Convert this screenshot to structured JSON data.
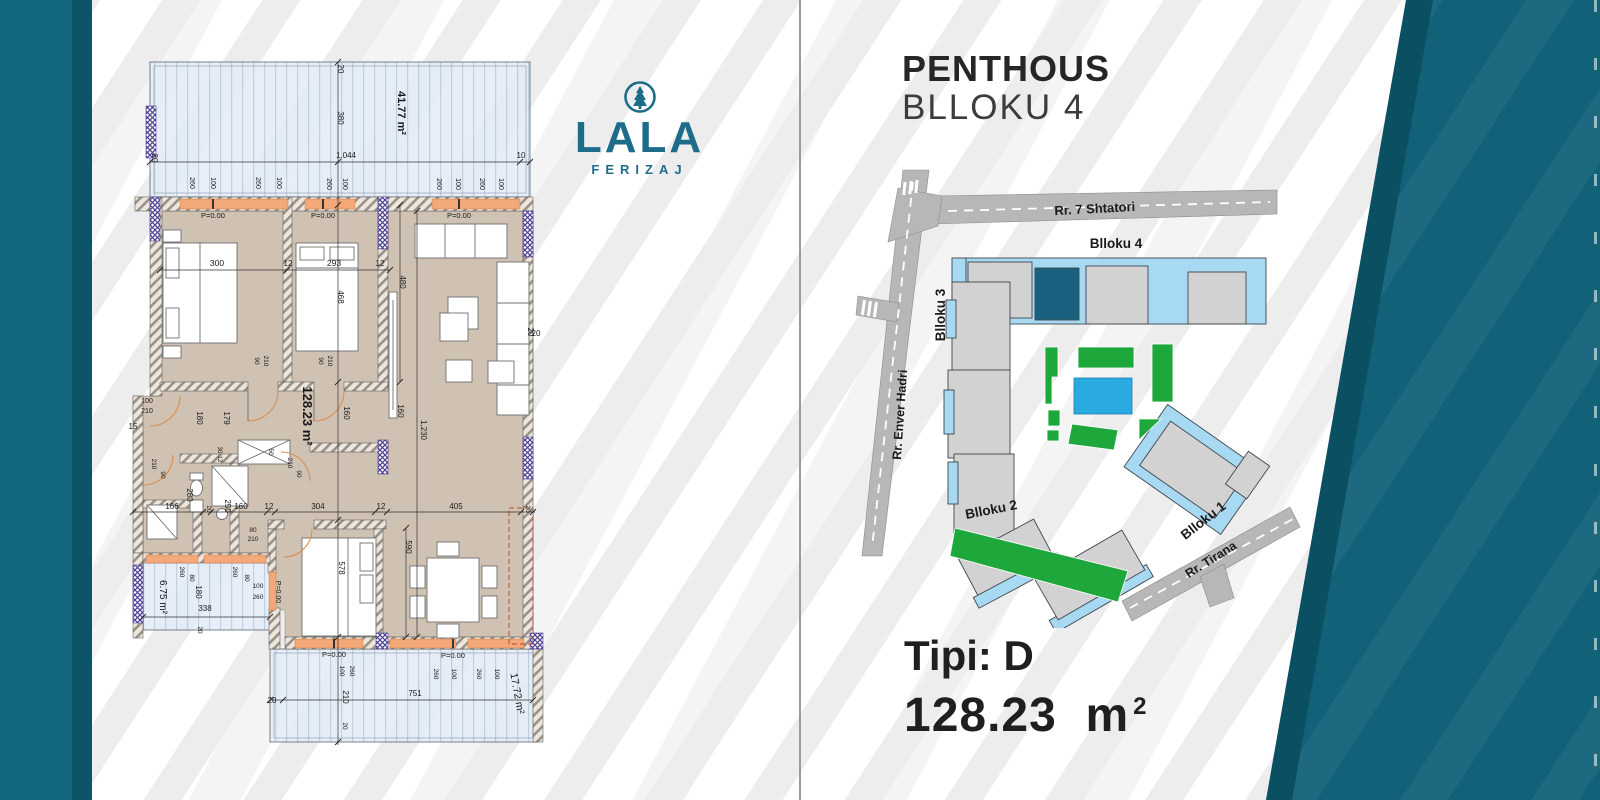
{
  "page": {
    "stripe_color": "#ededed",
    "teal_bar": "#13677f",
    "teal_dark": "#0c5468",
    "teal_wedge": "#116178"
  },
  "logo": {
    "name": "LALA",
    "city": "FERIZAJ",
    "color": "#1d6d8a",
    "icon": "pine-tree-circle-icon"
  },
  "header": {
    "line1": "PENTHOUS",
    "line2": "BLLOKU 4"
  },
  "type_block": {
    "label": "Tipi: D",
    "area_value": "128.23",
    "area_unit": "m",
    "area_sup": "2"
  },
  "floorplan": {
    "colors": {
      "floor": "#cfc2b2",
      "terrace": "#e3ecf7",
      "sill": "#f2a878",
      "column": "#4b3f92",
      "door_arc": "#dd8c4c",
      "dashed_outline": "#c4452e"
    },
    "labels": [
      {
        "t": "41.77 m²",
        "x": 398,
        "y": 113,
        "r": 90,
        "s": 11,
        "b": 1
      },
      {
        "t": "128.23 m²",
        "x": 303,
        "y": 416,
        "r": 90,
        "s": 13,
        "b": 1
      },
      {
        "t": "6.75 m²",
        "x": 160,
        "y": 597,
        "r": 90,
        "s": 10
      },
      {
        "t": "17.72 m²",
        "x": 514,
        "y": 694,
        "r": 80,
        "s": 10.5
      },
      {
        "t": "380",
        "x": 338,
        "y": 118,
        "r": 90,
        "s": 8
      },
      {
        "t": "20",
        "x": 338,
        "y": 69,
        "r": 90,
        "s": 8
      },
      {
        "t": "1,044",
        "x": 346,
        "y": 158,
        "s": 8
      },
      {
        "t": "10",
        "x": 521,
        "y": 158,
        "s": 8
      },
      {
        "t": "20",
        "x": 152,
        "y": 158,
        "r": 90,
        "s": 8
      },
      {
        "t": "260",
        "x": 190,
        "y": 183,
        "r": 90,
        "s": 7
      },
      {
        "t": "100",
        "x": 211,
        "y": 183,
        "r": 90,
        "s": 7
      },
      {
        "t": "260",
        "x": 256,
        "y": 183,
        "r": 90,
        "s": 7
      },
      {
        "t": "100",
        "x": 277,
        "y": 183,
        "r": 90,
        "s": 7
      },
      {
        "t": "260",
        "x": 327,
        "y": 184,
        "r": 90,
        "s": 7
      },
      {
        "t": "100",
        "x": 343,
        "y": 184,
        "r": 90,
        "s": 7
      },
      {
        "t": "260",
        "x": 437,
        "y": 184,
        "r": 90,
        "s": 7
      },
      {
        "t": "100",
        "x": 456,
        "y": 184,
        "r": 90,
        "s": 7
      },
      {
        "t": "260",
        "x": 480,
        "y": 184,
        "r": 90,
        "s": 7
      },
      {
        "t": "100",
        "x": 499,
        "y": 184,
        "r": 90,
        "s": 7
      },
      {
        "t": "P=0.00",
        "x": 213,
        "y": 218,
        "s": 7.5
      },
      {
        "t": "P=0.00",
        "x": 323,
        "y": 218,
        "s": 7.5
      },
      {
        "t": "P=0.00",
        "x": 459,
        "y": 218,
        "s": 7.5
      },
      {
        "t": "P=0.00",
        "x": 334,
        "y": 657,
        "s": 7.5
      },
      {
        "t": "P=0.00",
        "x": 453,
        "y": 658,
        "s": 7.5
      },
      {
        "t": "P=0.00",
        "x": 276,
        "y": 592,
        "r": 90,
        "s": 7
      },
      {
        "t": "300",
        "x": 217,
        "y": 266,
        "s": 8.5
      },
      {
        "t": "12",
        "x": 288,
        "y": 266,
        "s": 8
      },
      {
        "t": "293",
        "x": 334,
        "y": 266,
        "s": 8.5
      },
      {
        "t": "12",
        "x": 380,
        "y": 266,
        "s": 8
      },
      {
        "t": "468",
        "x": 338,
        "y": 297,
        "r": 90,
        "s": 8
      },
      {
        "t": "480",
        "x": 400,
        "y": 282,
        "r": 90,
        "s": 8
      },
      {
        "t": "20",
        "x": 528,
        "y": 332,
        "r": 90,
        "s": 8
      },
      {
        "t": "20",
        "x": 536,
        "y": 336,
        "s": 8
      },
      {
        "t": "160",
        "x": 344,
        "y": 413,
        "r": 90,
        "s": 8
      },
      {
        "t": "160",
        "x": 398,
        "y": 411,
        "r": 90,
        "s": 8
      },
      {
        "t": "1,230",
        "x": 421,
        "y": 430,
        "r": 90,
        "s": 8
      },
      {
        "t": "90",
        "x": 255,
        "y": 361,
        "r": 90,
        "s": 6.5
      },
      {
        "t": "210",
        "x": 264,
        "y": 361,
        "r": 90,
        "s": 6.5
      },
      {
        "t": "90",
        "x": 319,
        "y": 361,
        "r": 90,
        "s": 6.5
      },
      {
        "t": "210",
        "x": 328,
        "y": 361,
        "r": 90,
        "s": 6.5
      },
      {
        "t": "100",
        "x": 147,
        "y": 403,
        "s": 7
      },
      {
        "t": "210",
        "x": 147,
        "y": 413,
        "s": 7
      },
      {
        "t": "15",
        "x": 133,
        "y": 429,
        "s": 8
      },
      {
        "t": "210",
        "x": 152,
        "y": 464,
        "r": 90,
        "s": 6.5
      },
      {
        "t": "90",
        "x": 161,
        "y": 475,
        "r": 90,
        "s": 6.5
      },
      {
        "t": "180",
        "x": 197,
        "y": 418,
        "r": 90,
        "s": 8
      },
      {
        "t": "179",
        "x": 224,
        "y": 418,
        "r": 90,
        "s": 8
      },
      {
        "t": "30",
        "x": 218,
        "y": 450,
        "r": 90,
        "s": 6
      },
      {
        "t": "12",
        "x": 218,
        "y": 459,
        "r": 90,
        "s": 6
      },
      {
        "t": "50",
        "x": 269,
        "y": 452,
        "r": 90,
        "s": 6.5
      },
      {
        "t": "210",
        "x": 288,
        "y": 463,
        "r": 90,
        "s": 6.5
      },
      {
        "t": "90",
        "x": 297,
        "y": 474,
        "r": 90,
        "s": 6.5
      },
      {
        "t": "280",
        "x": 187,
        "y": 495,
        "r": 90,
        "s": 8
      },
      {
        "t": "250",
        "x": 225,
        "y": 506,
        "r": 90,
        "s": 8
      },
      {
        "t": "166",
        "x": 172,
        "y": 509,
        "s": 8
      },
      {
        "t": "20",
        "x": 207,
        "y": 509,
        "r": 90,
        "s": 6.5
      },
      {
        "t": "160",
        "x": 241,
        "y": 509,
        "s": 8
      },
      {
        "t": "12",
        "x": 269,
        "y": 509,
        "s": 8
      },
      {
        "t": "304",
        "x": 318,
        "y": 509,
        "s": 8
      },
      {
        "t": "12",
        "x": 381,
        "y": 509,
        "s": 8
      },
      {
        "t": "405",
        "x": 456,
        "y": 509,
        "s": 8
      },
      {
        "t": "20",
        "x": 526,
        "y": 509,
        "r": 90,
        "s": 6.5
      },
      {
        "t": "80",
        "x": 253,
        "y": 532,
        "s": 6.5
      },
      {
        "t": "210",
        "x": 253,
        "y": 541,
        "s": 6.5
      },
      {
        "t": "590",
        "x": 406,
        "y": 547,
        "r": 90,
        "s": 8
      },
      {
        "t": "578",
        "x": 339,
        "y": 568,
        "r": 90,
        "s": 8
      },
      {
        "t": "260",
        "x": 180,
        "y": 572,
        "r": 90,
        "s": 6.5
      },
      {
        "t": "80",
        "x": 190,
        "y": 578,
        "r": 90,
        "s": 6.5
      },
      {
        "t": "260",
        "x": 233,
        "y": 572,
        "r": 90,
        "s": 6.5
      },
      {
        "t": "80",
        "x": 245,
        "y": 578,
        "r": 90,
        "s": 6.5
      },
      {
        "t": "180",
        "x": 196,
        "y": 592,
        "r": 90,
        "s": 8
      },
      {
        "t": "100",
        "x": 258,
        "y": 588,
        "s": 6.5
      },
      {
        "t": "260",
        "x": 258,
        "y": 599,
        "s": 6.5
      },
      {
        "t": "338",
        "x": 205,
        "y": 611,
        "s": 8
      },
      {
        "t": "20",
        "x": 198,
        "y": 630,
        "r": 90,
        "s": 6.5
      },
      {
        "t": "100",
        "x": 340,
        "y": 671,
        "r": 90,
        "s": 6.5
      },
      {
        "t": "260",
        "x": 350,
        "y": 671,
        "r": 90,
        "s": 6.5
      },
      {
        "t": "210",
        "x": 343,
        "y": 697,
        "r": 90,
        "s": 8
      },
      {
        "t": "20",
        "x": 343,
        "y": 726,
        "r": 90,
        "s": 6.5
      },
      {
        "t": "260",
        "x": 434,
        "y": 674,
        "r": 90,
        "s": 6.5
      },
      {
        "t": "100",
        "x": 452,
        "y": 674,
        "r": 90,
        "s": 6.5
      },
      {
        "t": "260",
        "x": 477,
        "y": 674,
        "r": 90,
        "s": 6.5
      },
      {
        "t": "100",
        "x": 495,
        "y": 674,
        "r": 90,
        "s": 6.5
      },
      {
        "t": "751",
        "x": 415,
        "y": 696,
        "s": 8
      },
      {
        "t": "20",
        "x": 272,
        "y": 703,
        "s": 8
      }
    ]
  },
  "sitemap": {
    "colors": {
      "building_gray": "#d2d2d2",
      "building_blue": "#a8d9f2",
      "highlight_teal": "#19617e",
      "green": "#1ea83c",
      "pool": "#29abe2",
      "road": "#b7b7b7"
    },
    "labels": [
      {
        "t": "Rr. 7 Shtatori",
        "x": 1095,
        "y": 213,
        "r": -3,
        "s": 13,
        "b": 1
      },
      {
        "t": "Rr. Enver Hadri",
        "x": 904,
        "y": 415,
        "r": -86,
        "s": 12.5,
        "b": 1
      },
      {
        "t": "Rr. Tirana",
        "x": 1213,
        "y": 563,
        "r": -32,
        "s": 12.5,
        "b": 1
      },
      {
        "t": "Blloku 4",
        "x": 1116,
        "y": 248,
        "s": 13.5,
        "b": 1
      },
      {
        "t": "Blloku 3",
        "x": 945,
        "y": 315,
        "r": -90,
        "s": 13.5,
        "b": 1
      },
      {
        "t": "Blloku 2",
        "x": 992,
        "y": 514,
        "r": -11,
        "s": 13.5,
        "b": 1
      },
      {
        "t": "Blloku 1",
        "x": 1206,
        "y": 524,
        "r": -38,
        "s": 13.5,
        "b": 1
      }
    ]
  }
}
